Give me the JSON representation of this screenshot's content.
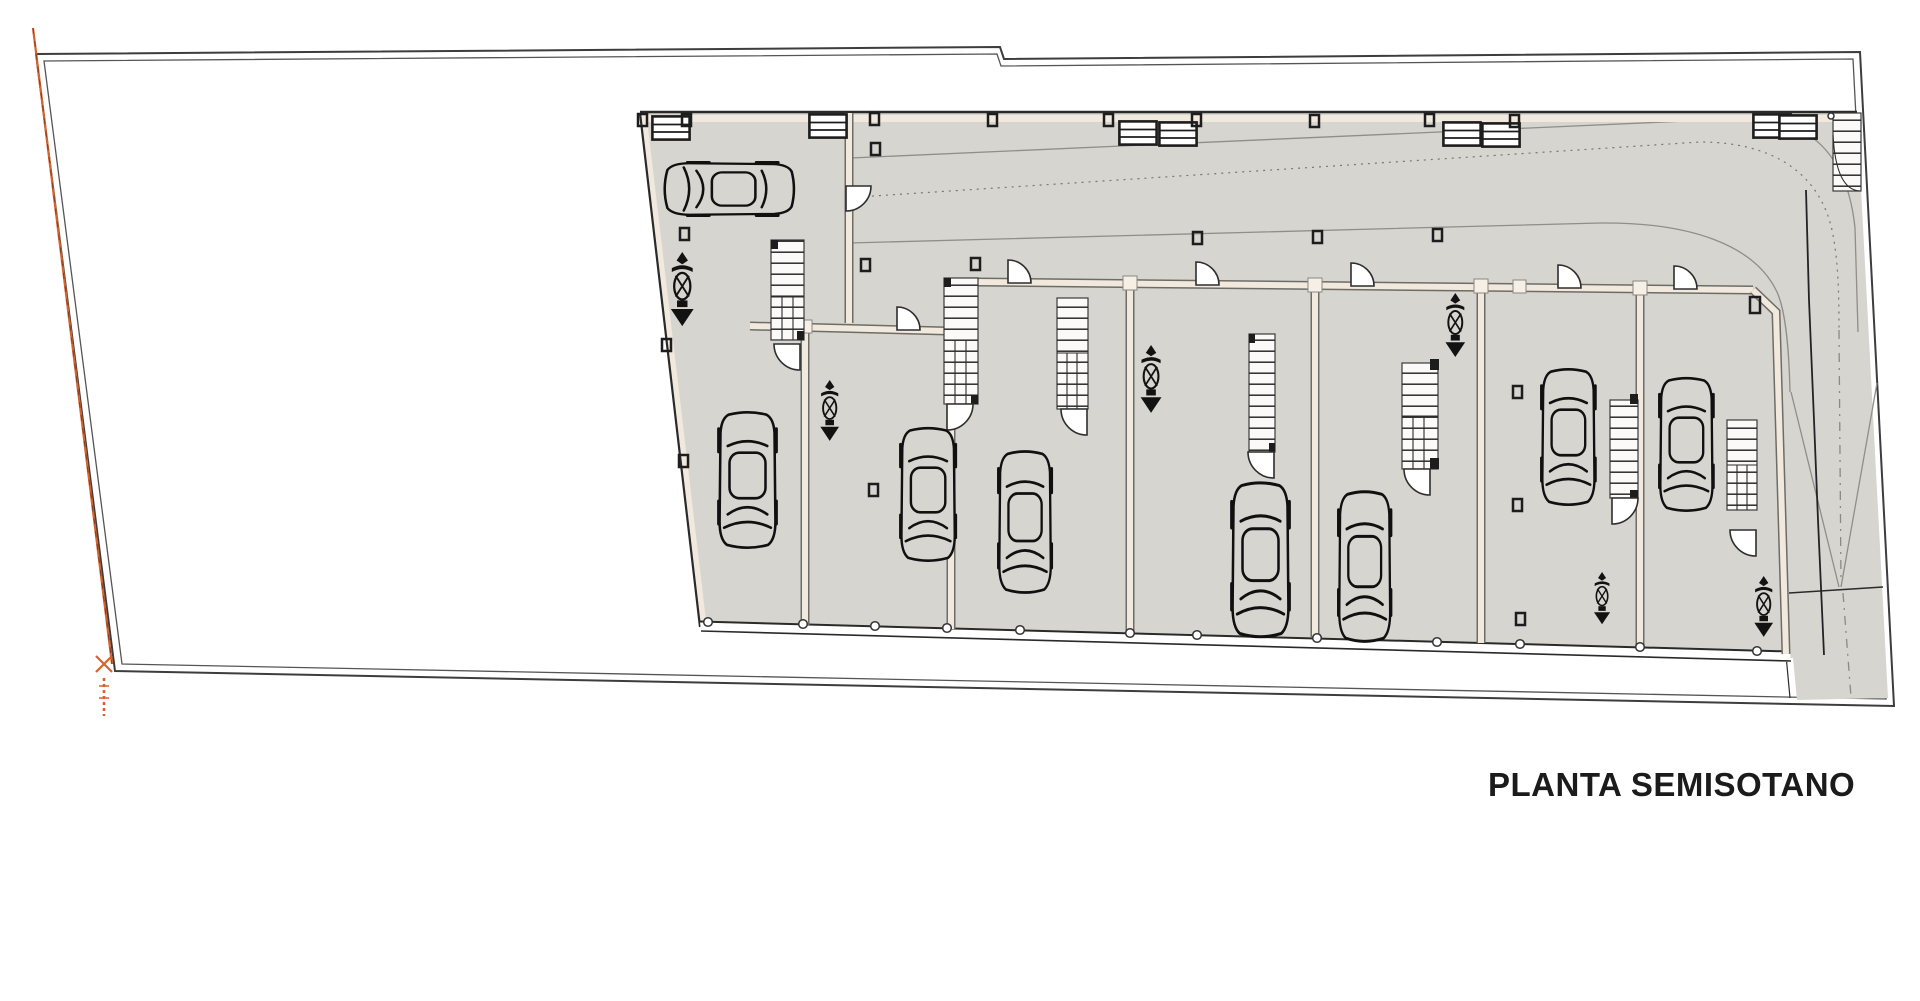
{
  "drawing": {
    "title": "PLANTA SEMISOTANO"
  },
  "colors": {
    "paper": "#ffffff",
    "floor": "#d6d5d0",
    "wall": "#f1e9de",
    "walledge": "#6f6c66",
    "lane": "#8f8e89",
    "accent": "#d9622c"
  },
  "inventory": {
    "garage_bays": 7,
    "cars": 8,
    "motorcycles": 6,
    "staircases": 8,
    "door_swings": 14,
    "ramps": 1
  }
}
